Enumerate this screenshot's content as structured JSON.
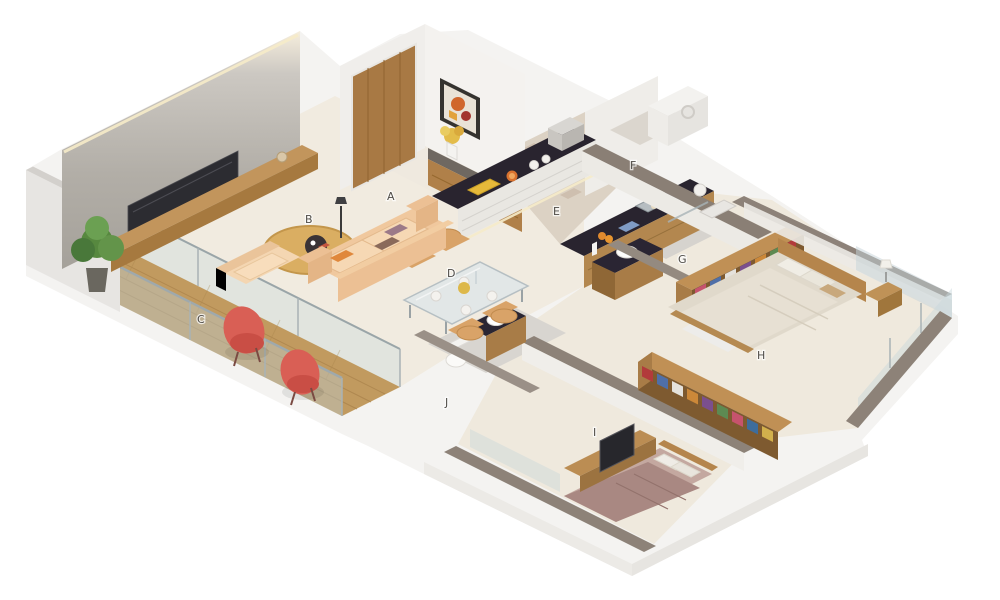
{
  "scene": {
    "description": "3D isometric cutaway floor plan render of a 2BHK apartment",
    "background": "#ffffff"
  },
  "rooms": [
    {
      "letter": "A"
    },
    {
      "letter": "B"
    },
    {
      "letter": "C"
    },
    {
      "letter": "D"
    },
    {
      "letter": "E"
    },
    {
      "letter": "F"
    },
    {
      "letter": "G"
    },
    {
      "letter": "H"
    },
    {
      "letter": "I"
    },
    {
      "letter": "J"
    }
  ],
  "palette": {
    "floor_cream": "#f1ebe0",
    "tile_gray": "#d8d5d0",
    "balcony_wood": "#c19a5f",
    "wall_white": "#f2f1ee",
    "wall_cap_taupe": "#8d8278",
    "concrete_wall": "#b2aea7",
    "counter_dark": "#29242f",
    "furniture_wood": "#b3874f",
    "door_wood": "#a87944",
    "sofa_peach": "#f0c89e",
    "red_chair": "#d95f55",
    "bed_beige": "#e0d9cb",
    "bed_mauve": "#a98882",
    "glass": "#cfe0e4",
    "plant_green": "#57883f",
    "label_color": "#4f4c47"
  }
}
